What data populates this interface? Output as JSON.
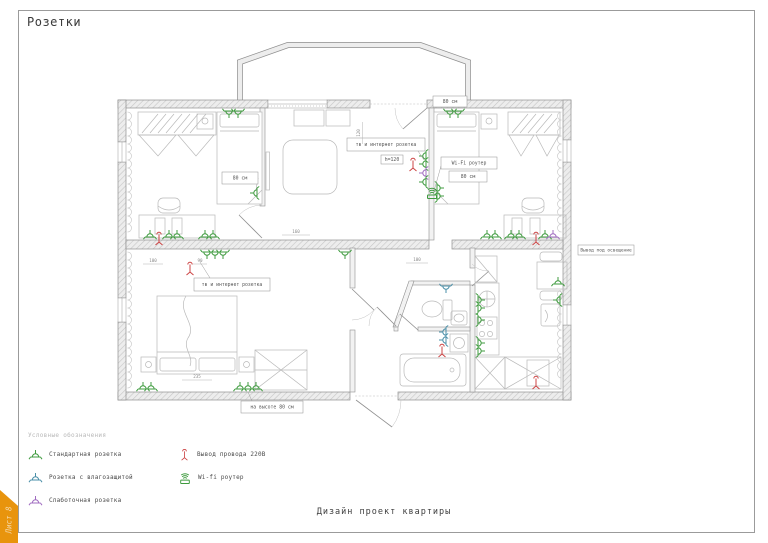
{
  "page": {
    "title": "Розетки",
    "sheet_label": "Лист 8",
    "footer": "Дизайн проект квартиры"
  },
  "colors": {
    "accent_orange": "#e8940d",
    "ribbon_text": "#f6d9a9",
    "socket_standard": "#3f9b3f",
    "socket_moisture": "#4a8fa8",
    "socket_low_voltage": "#a06cc0",
    "wire_output": "#cc4444",
    "wifi": "#3f9b3f"
  },
  "legend": {
    "heading": "Условные обозначения",
    "items": [
      {
        "label": "Стандартная розетка",
        "type": "socket-standard"
      },
      {
        "label": "Розетка с влагозащитой",
        "type": "socket-moisture"
      },
      {
        "label": "Слаботочная розетка",
        "type": "socket-low-voltage"
      },
      {
        "label": "Вывод провода 220В",
        "type": "wire-output"
      },
      {
        "label": "Wi-fi роутер",
        "type": "wifi-router"
      }
    ]
  },
  "plan": {
    "boxes": [
      {
        "text": "80 см",
        "x": 433,
        "y": 96,
        "w": 34,
        "h": 11
      },
      {
        "text": "тв и интернет розетка",
        "x": 347,
        "y": 138,
        "w": 78,
        "h": 13,
        "leader": [
          418,
          151,
          424,
          160
        ]
      },
      {
        "text": "h=120",
        "x": 381,
        "y": 155,
        "w": 22,
        "h": 9
      },
      {
        "text": "Wi-Fi роутер",
        "x": 441,
        "y": 157,
        "w": 56,
        "h": 12,
        "leader": [
          441,
          166,
          434,
          191
        ]
      },
      {
        "text": "80 см",
        "x": 449,
        "y": 171,
        "w": 38,
        "h": 11
      },
      {
        "text": "80 см",
        "x": 222,
        "y": 172,
        "w": 36,
        "h": 12,
        "leader": [
          258,
          178,
          256,
          190
        ]
      },
      {
        "text": "тв и интернет розетка",
        "x": 194,
        "y": 278,
        "w": 76,
        "h": 13,
        "leader": [
          210,
          278,
          200,
          262
        ]
      },
      {
        "text": "на высоте 80 см",
        "x": 241,
        "y": 401,
        "w": 62,
        "h": 12,
        "leader": [
          252,
          401,
          248,
          392
        ]
      },
      {
        "text": "Вывод под освещение",
        "x": 578,
        "y": 245,
        "w": 56,
        "h": 10
      }
    ],
    "dims": [
      {
        "text": "100",
        "x": 417,
        "y": 261,
        "len": 22
      },
      {
        "text": "100",
        "x": 153,
        "y": 262,
        "len": 20
      },
      {
        "text": "90",
        "x": 200,
        "y": 262,
        "len": 14
      },
      {
        "text": "160",
        "x": 296,
        "y": 233,
        "len": 28
      },
      {
        "text": "120",
        "x": 360,
        "y": 133,
        "len": 22,
        "vert": true
      },
      {
        "text": "235",
        "x": 197,
        "y": 378,
        "len": 30
      }
    ],
    "sockets": [
      {
        "x": 150,
        "y": 237,
        "r": 0,
        "k": "std"
      },
      {
        "x": 159,
        "y": 237,
        "r": 0,
        "k": "out"
      },
      {
        "x": 169,
        "y": 237,
        "r": 0,
        "k": "std"
      },
      {
        "x": 177,
        "y": 237,
        "r": 0,
        "k": "std"
      },
      {
        "x": 205,
        "y": 237,
        "r": 0,
        "k": "std"
      },
      {
        "x": 213,
        "y": 237,
        "r": 0,
        "k": "std"
      },
      {
        "x": 229,
        "y": 111,
        "r": 180,
        "k": "std"
      },
      {
        "x": 238,
        "y": 111,
        "r": 180,
        "k": "std"
      },
      {
        "x": 257,
        "y": 193,
        "r": -90,
        "k": "std"
      },
      {
        "x": 426,
        "y": 156,
        "r": -90,
        "k": "std"
      },
      {
        "x": 426,
        "y": 164,
        "r": -90,
        "k": "std"
      },
      {
        "x": 426,
        "y": 173,
        "r": -90,
        "k": "low"
      },
      {
        "x": 426,
        "y": 182,
        "r": -90,
        "k": "std"
      },
      {
        "x": 413,
        "y": 163,
        "r": 0,
        "k": "out"
      },
      {
        "x": 432,
        "y": 196,
        "r": 0,
        "k": "wifi"
      },
      {
        "x": 450,
        "y": 111,
        "r": 180,
        "k": "std"
      },
      {
        "x": 458,
        "y": 111,
        "r": 180,
        "k": "std"
      },
      {
        "x": 437,
        "y": 188,
        "r": 90,
        "k": "std"
      },
      {
        "x": 437,
        "y": 196,
        "r": 90,
        "k": "std"
      },
      {
        "x": 487,
        "y": 237,
        "r": 0,
        "k": "std"
      },
      {
        "x": 495,
        "y": 237,
        "r": 0,
        "k": "std"
      },
      {
        "x": 511,
        "y": 237,
        "r": 0,
        "k": "std"
      },
      {
        "x": 519,
        "y": 237,
        "r": 0,
        "k": "std"
      },
      {
        "x": 536,
        "y": 237,
        "r": 0,
        "k": "out"
      },
      {
        "x": 545,
        "y": 237,
        "r": 0,
        "k": "std"
      },
      {
        "x": 553,
        "y": 237,
        "r": 0,
        "k": "low"
      },
      {
        "x": 207,
        "y": 252,
        "r": 180,
        "k": "std"
      },
      {
        "x": 215,
        "y": 252,
        "r": 180,
        "k": "std"
      },
      {
        "x": 223,
        "y": 252,
        "r": 180,
        "k": "std"
      },
      {
        "x": 345,
        "y": 252,
        "r": 180,
        "k": "std"
      },
      {
        "x": 190,
        "y": 267,
        "r": 0,
        "k": "out"
      },
      {
        "x": 143,
        "y": 389,
        "r": 0,
        "k": "std"
      },
      {
        "x": 151,
        "y": 389,
        "r": 0,
        "k": "std"
      },
      {
        "x": 240,
        "y": 389,
        "r": 0,
        "k": "std"
      },
      {
        "x": 248,
        "y": 389,
        "r": 0,
        "k": "std"
      },
      {
        "x": 256,
        "y": 389,
        "r": 0,
        "k": "std"
      },
      {
        "x": 446,
        "y": 286,
        "r": 180,
        "k": "moist"
      },
      {
        "x": 446,
        "y": 332,
        "r": -90,
        "k": "moist"
      },
      {
        "x": 446,
        "y": 340,
        "r": -90,
        "k": "moist"
      },
      {
        "x": 442,
        "y": 349,
        "r": 0,
        "k": "out"
      },
      {
        "x": 478,
        "y": 300,
        "r": 90,
        "k": "std"
      },
      {
        "x": 478,
        "y": 308,
        "r": 90,
        "k": "std"
      },
      {
        "x": 478,
        "y": 320,
        "r": 90,
        "k": "std"
      },
      {
        "x": 478,
        "y": 343,
        "r": 90,
        "k": "std"
      },
      {
        "x": 478,
        "y": 351,
        "r": 90,
        "k": "std"
      },
      {
        "x": 558,
        "y": 284,
        "r": 0,
        "k": "std"
      },
      {
        "x": 560,
        "y": 300,
        "r": -90,
        "k": "std"
      },
      {
        "x": 536,
        "y": 381,
        "r": 0,
        "k": "out"
      }
    ]
  }
}
